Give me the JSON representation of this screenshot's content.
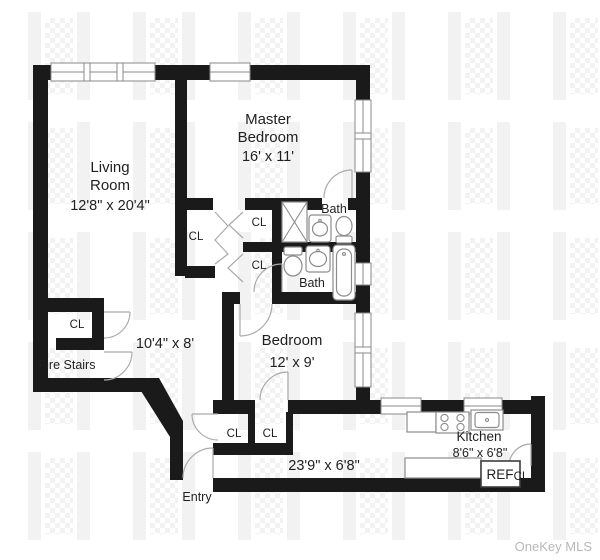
{
  "brand": "OneKey MLS",
  "colors": {
    "wall": "#1a1a1a",
    "door_stroke": "#ababab",
    "fixture_stroke": "#8c8c8c",
    "watermark": "#f2f2f2",
    "brand_text": "#b8b8b8"
  },
  "labels": {
    "living_room": {
      "l1": "Living",
      "l2": "Room",
      "dims": "12'8\" x 20'4\""
    },
    "master_bedroom": {
      "l1": "Master",
      "l2": "Bedroom",
      "dims": "16' x 11'"
    },
    "bedroom": {
      "l1": "Bedroom",
      "dims": "12' x 9'"
    },
    "kitchen": {
      "l1": "Kitchen",
      "dims": "8'6\" x 6'8\""
    },
    "bath_top": "Bath",
    "bath_bottom": "Bath",
    "hall_upper_dims": "10'4\" x 8'",
    "hall_lower_dims": "23'9\" x 6'8\"",
    "fire_stairs": "Fire Stairs",
    "entry": "Entry",
    "refrigerator": "REF",
    "closets": [
      {
        "label": "CL"
      },
      {
        "label": "CL"
      },
      {
        "label": "CL"
      },
      {
        "label": "CL"
      },
      {
        "label": "CL"
      },
      {
        "label": "CL"
      },
      {
        "label": "CL"
      }
    ]
  }
}
